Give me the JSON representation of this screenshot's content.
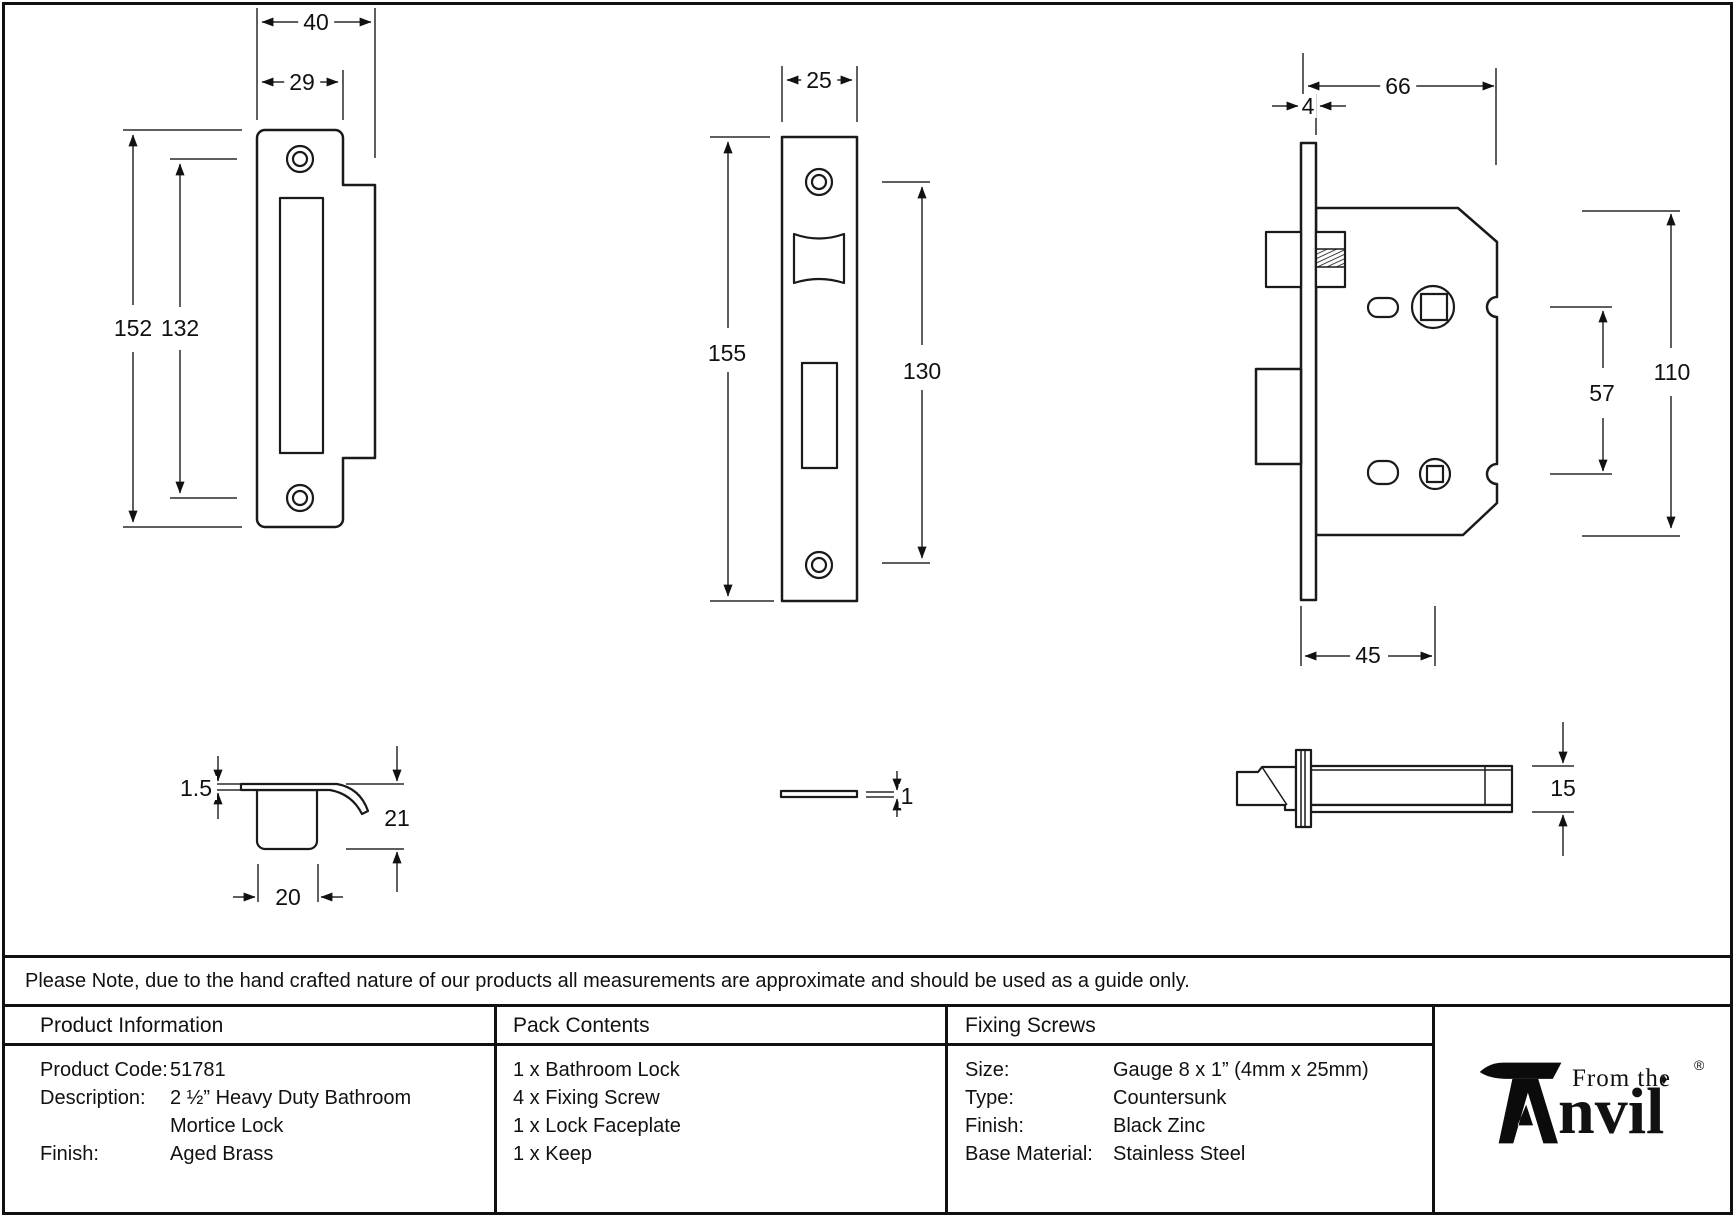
{
  "colors": {
    "line": "#1a1a1a",
    "background": "#ffffff"
  },
  "drawings": {
    "keep_front": {
      "dims": {
        "overall_width": "40",
        "plate_width": "29",
        "overall_height": "152",
        "hole_spacing": "132"
      }
    },
    "faceplate_front": {
      "dims": {
        "width": "25",
        "height": "155",
        "hole_spacing": "130"
      }
    },
    "lock_front": {
      "dims": {
        "case_depth": "66",
        "faceplate_thickness": "4",
        "case_height": "110",
        "follower_spacing": "57",
        "backset": "45"
      }
    },
    "keep_profile": {
      "dims": {
        "plate_thickness": "1.5",
        "depth": "21",
        "box_width": "20"
      }
    },
    "faceplate_side": {
      "dims": {
        "thickness": "1"
      }
    },
    "lock_side": {
      "dims": {
        "case_thickness": "15"
      }
    }
  },
  "note": "Please Note, due to the hand crafted nature of our products all measurements are approximate and should be used as a guide only.",
  "table": {
    "product_information": {
      "title": "Product Information",
      "rows": [
        {
          "label": "Product Code:",
          "value": "51781"
        },
        {
          "label": "Description:",
          "value": "2 ½” Heavy Duty Bathroom"
        },
        {
          "label": "",
          "value": "Mortice Lock"
        },
        {
          "label": "Finish:",
          "value": "Aged Brass"
        }
      ]
    },
    "pack_contents": {
      "title": "Pack Contents",
      "items": [
        "1 x Bathroom Lock",
        "4 x Fixing Screw",
        "1 x Lock Faceplate",
        "1 x Keep"
      ]
    },
    "fixing_screws": {
      "title": "Fixing Screws",
      "rows": [
        {
          "label": "Size:",
          "value": "Gauge 8 x 1” (4mm x 25mm)"
        },
        {
          "label": "Type:",
          "value": "Countersunk"
        },
        {
          "label": "Finish:",
          "value": "Black Zinc"
        },
        {
          "label": "Base Material:",
          "value": "Stainless Steel"
        }
      ]
    },
    "logo": {
      "from_the": "From the",
      "name": "nvil",
      "registered": "®",
      "diamond": "♦"
    }
  }
}
